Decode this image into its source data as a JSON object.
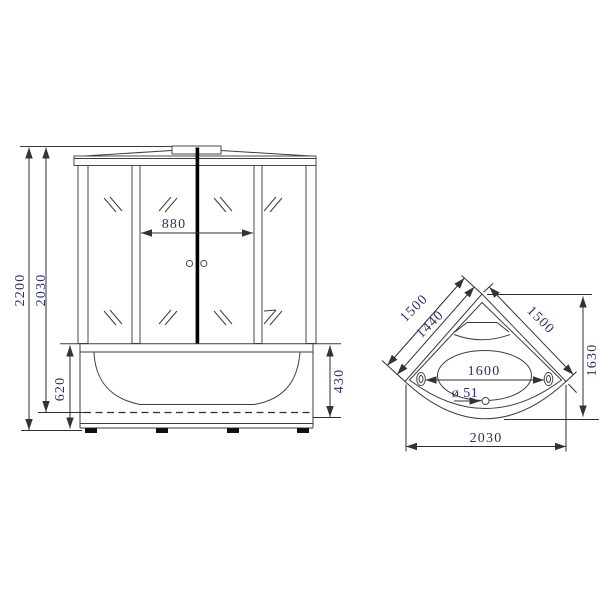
{
  "colors": {
    "line": "#3e3e3e",
    "dimension_text": "#283069",
    "door_seam": "#000000"
  },
  "front_view": {
    "total_height": "2200",
    "frame_height": "2030",
    "door_width": "880",
    "apron_height": "620",
    "tub_inner_depth": "430"
  },
  "top_view": {
    "left_side_outer": "1500",
    "left_side_inner": "1440",
    "right_side": "1500",
    "corner_depth": "1630",
    "inner_length": "1600",
    "drain_diameter": "ø 51",
    "overall_width": "2030"
  }
}
